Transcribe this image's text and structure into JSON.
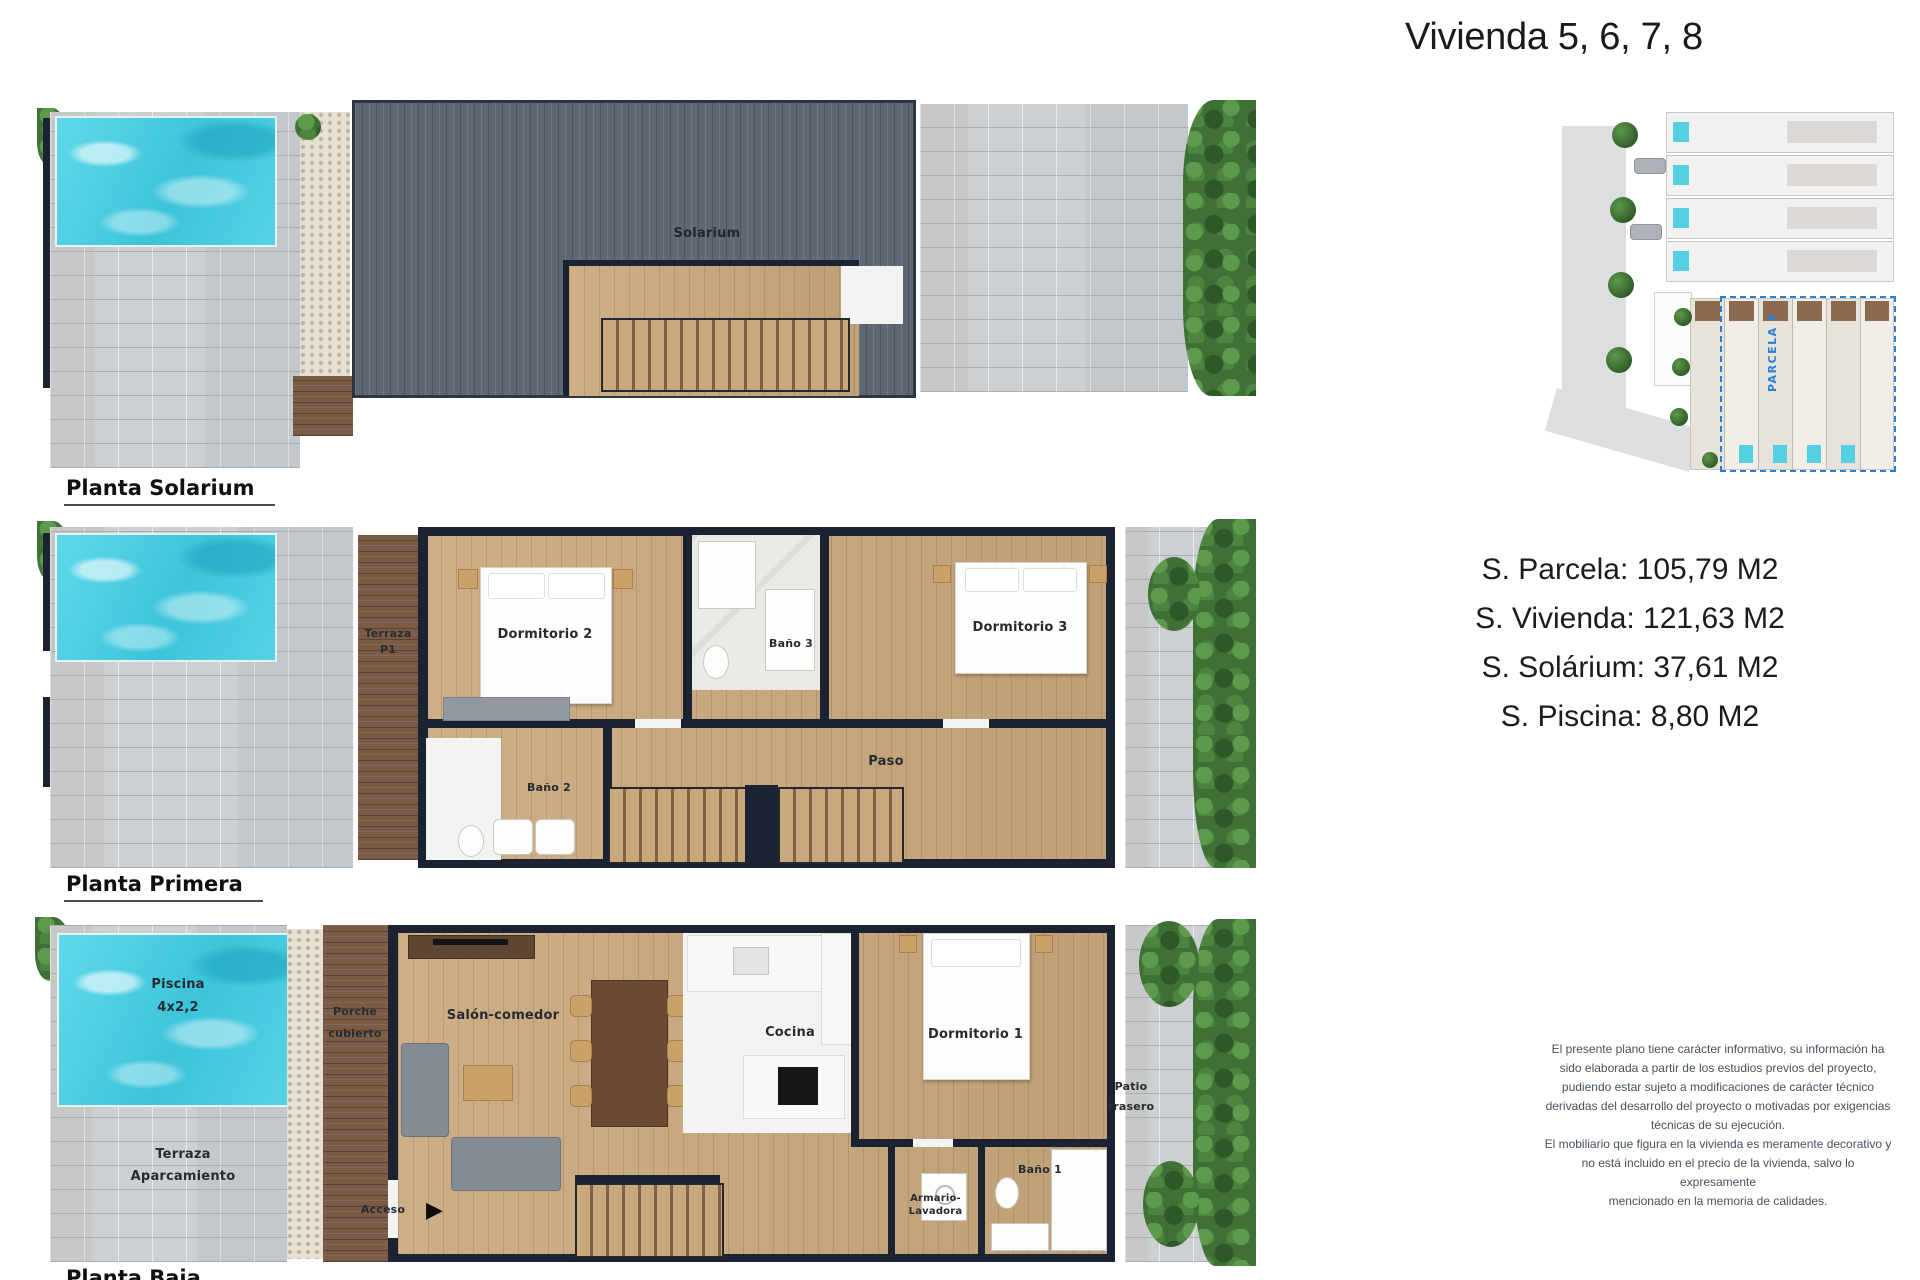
{
  "title": "Vivienda 5, 6, 7, 8",
  "plans": {
    "solarium": {
      "name": "Planta Solarium",
      "rooms": {
        "solarium": "Solarium"
      }
    },
    "primera": {
      "name": "Planta Primera",
      "rooms": {
        "terraza_l1": "Terraza",
        "terraza_l2": "P1",
        "dormitorio2": "Dormitorio 2",
        "bano3": "Baño 3",
        "dormitorio3": "Dormitorio 3",
        "bano2": "Baño 2",
        "paso": "Paso"
      }
    },
    "baja": {
      "name": "Planta Baja",
      "rooms": {
        "piscina_l1": "Piscina",
        "piscina_l2": "4x2,2",
        "porche_l1": "Porche",
        "porche_l2": "cubierto",
        "salon": "Salón-comedor",
        "cocina": "Cocina",
        "dormitorio1": "Dormitorio 1",
        "terraza_l1": "Terraza",
        "terraza_l2": "Aparcamiento",
        "acceso": "Acceso",
        "armario_l1": "Armario-",
        "armario_l2": "Lavadora",
        "bano1": "Baño 1",
        "patio_l1": "Patio",
        "patio_l2": "trasero"
      }
    }
  },
  "areas": {
    "parcela": "S. Parcela: 105,79 M2",
    "vivienda": "S. Vivienda: 121,63 M2",
    "solarium": "S. Solárium: 37,61 M2",
    "piscina": "S. Piscina: 8,80 M2"
  },
  "site_plan": {
    "parcela_label": "PARCELA F"
  },
  "icons": {
    "acceso_arrow": "▶"
  },
  "disclaimer": {
    "lines": [
      "El presente plano tiene carácter informativo, su información ha",
      "sido elaborada a partir de los estudios previos del proyecto,",
      "pudiendo estar sujeto a modificaciones de carácter técnico",
      "derivadas del desarrollo del proyecto o motivadas por exigencias",
      "técnicas de su ejecución.",
      "El mobiliario que figura en la vivienda es meramente decorativo y",
      "no está incluido en el precio de la vivienda, salvo lo expresamente",
      "mencionado en la memoria de calidades."
    ]
  },
  "colors": {
    "pool": "#49cfe2",
    "wall": "#1b2332",
    "wood_floor": "#c9a87d",
    "dark_wood": "#7b5b45",
    "deck": "#5e6874",
    "pavement": "#ccd0d3",
    "hedge": "#3f7136",
    "parcela_text": "#2a7fd4"
  }
}
